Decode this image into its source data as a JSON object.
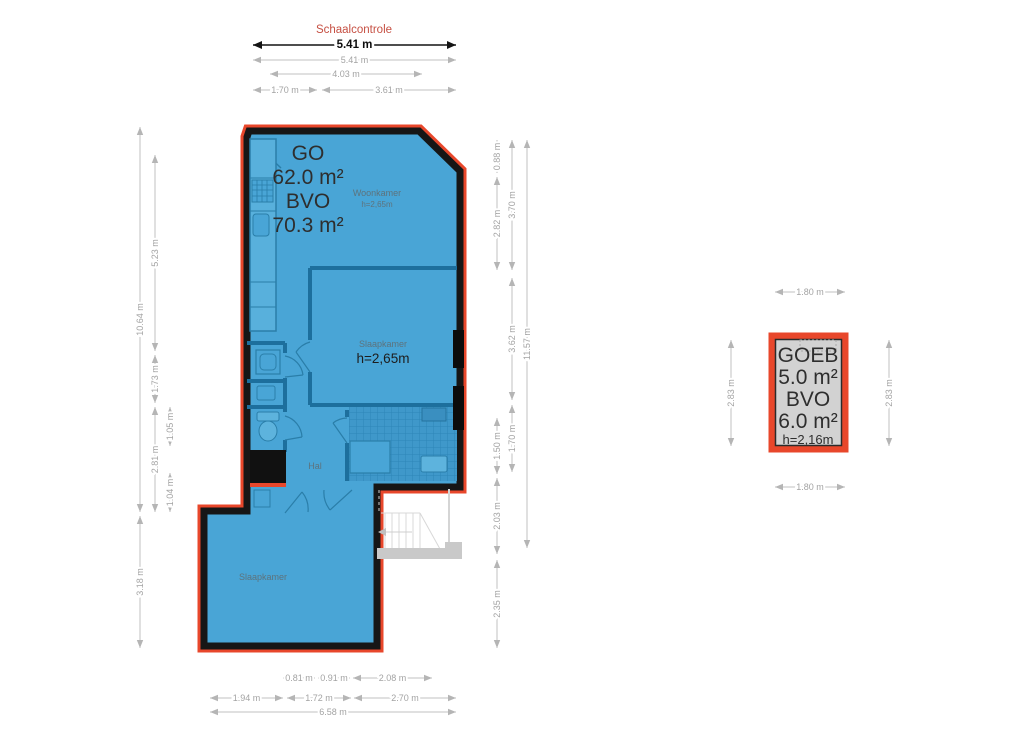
{
  "title": "Schaalcontrole",
  "main_unit": {
    "lines": [
      "GO",
      "62.0 m²",
      "BVO",
      "70.3 m²"
    ]
  },
  "rooms": {
    "woonkamer": {
      "name": "Woonkamer",
      "height": "h=2,65m"
    },
    "bedroom1": {
      "name": "Slaapkamer",
      "height": "h=2,65m"
    },
    "hal": {
      "name": "Hal"
    },
    "bedroom2": {
      "name": "Slaapkamer"
    }
  },
  "storage_unit": {
    "lines": [
      "GOEB",
      "5.0 m²",
      "BVO",
      "6.0 m²",
      "h=2,16m"
    ]
  },
  "dimensions": {
    "scale": "5.41 m",
    "top": [
      "5.41 m",
      "4.03 m",
      "1.70 m",
      "3.61 m"
    ],
    "left": [
      "10.64 m",
      "3.18 m",
      "5.23 m",
      "1.73 m",
      "2.81 m",
      "1.05 m",
      "1.04 m"
    ],
    "right": [
      "0.88 m",
      "2.82 m",
      "1.50 m",
      "2.03 m",
      "2.35 m",
      "3.70 m",
      "3.62 m",
      "1.70 m",
      "11.57 m"
    ],
    "bottom": [
      "0.81 m",
      "0.91 m",
      "2.08 m",
      "1.94 m",
      "1.72 m",
      "2.70 m",
      "6.58 m"
    ],
    "storage": [
      "1.80 m",
      "2.83 m",
      "2.83 m",
      "1.80 m"
    ]
  },
  "colors": {
    "outline_red": "#e8472b",
    "plan_blue": "#49a5d6",
    "wall_black": "#161616",
    "interior_wall_blue": "#1d6f9d",
    "storage_gray": "#d2d2d2",
    "dim_gray": "#b5b5b5",
    "title_red": "#c65043"
  }
}
